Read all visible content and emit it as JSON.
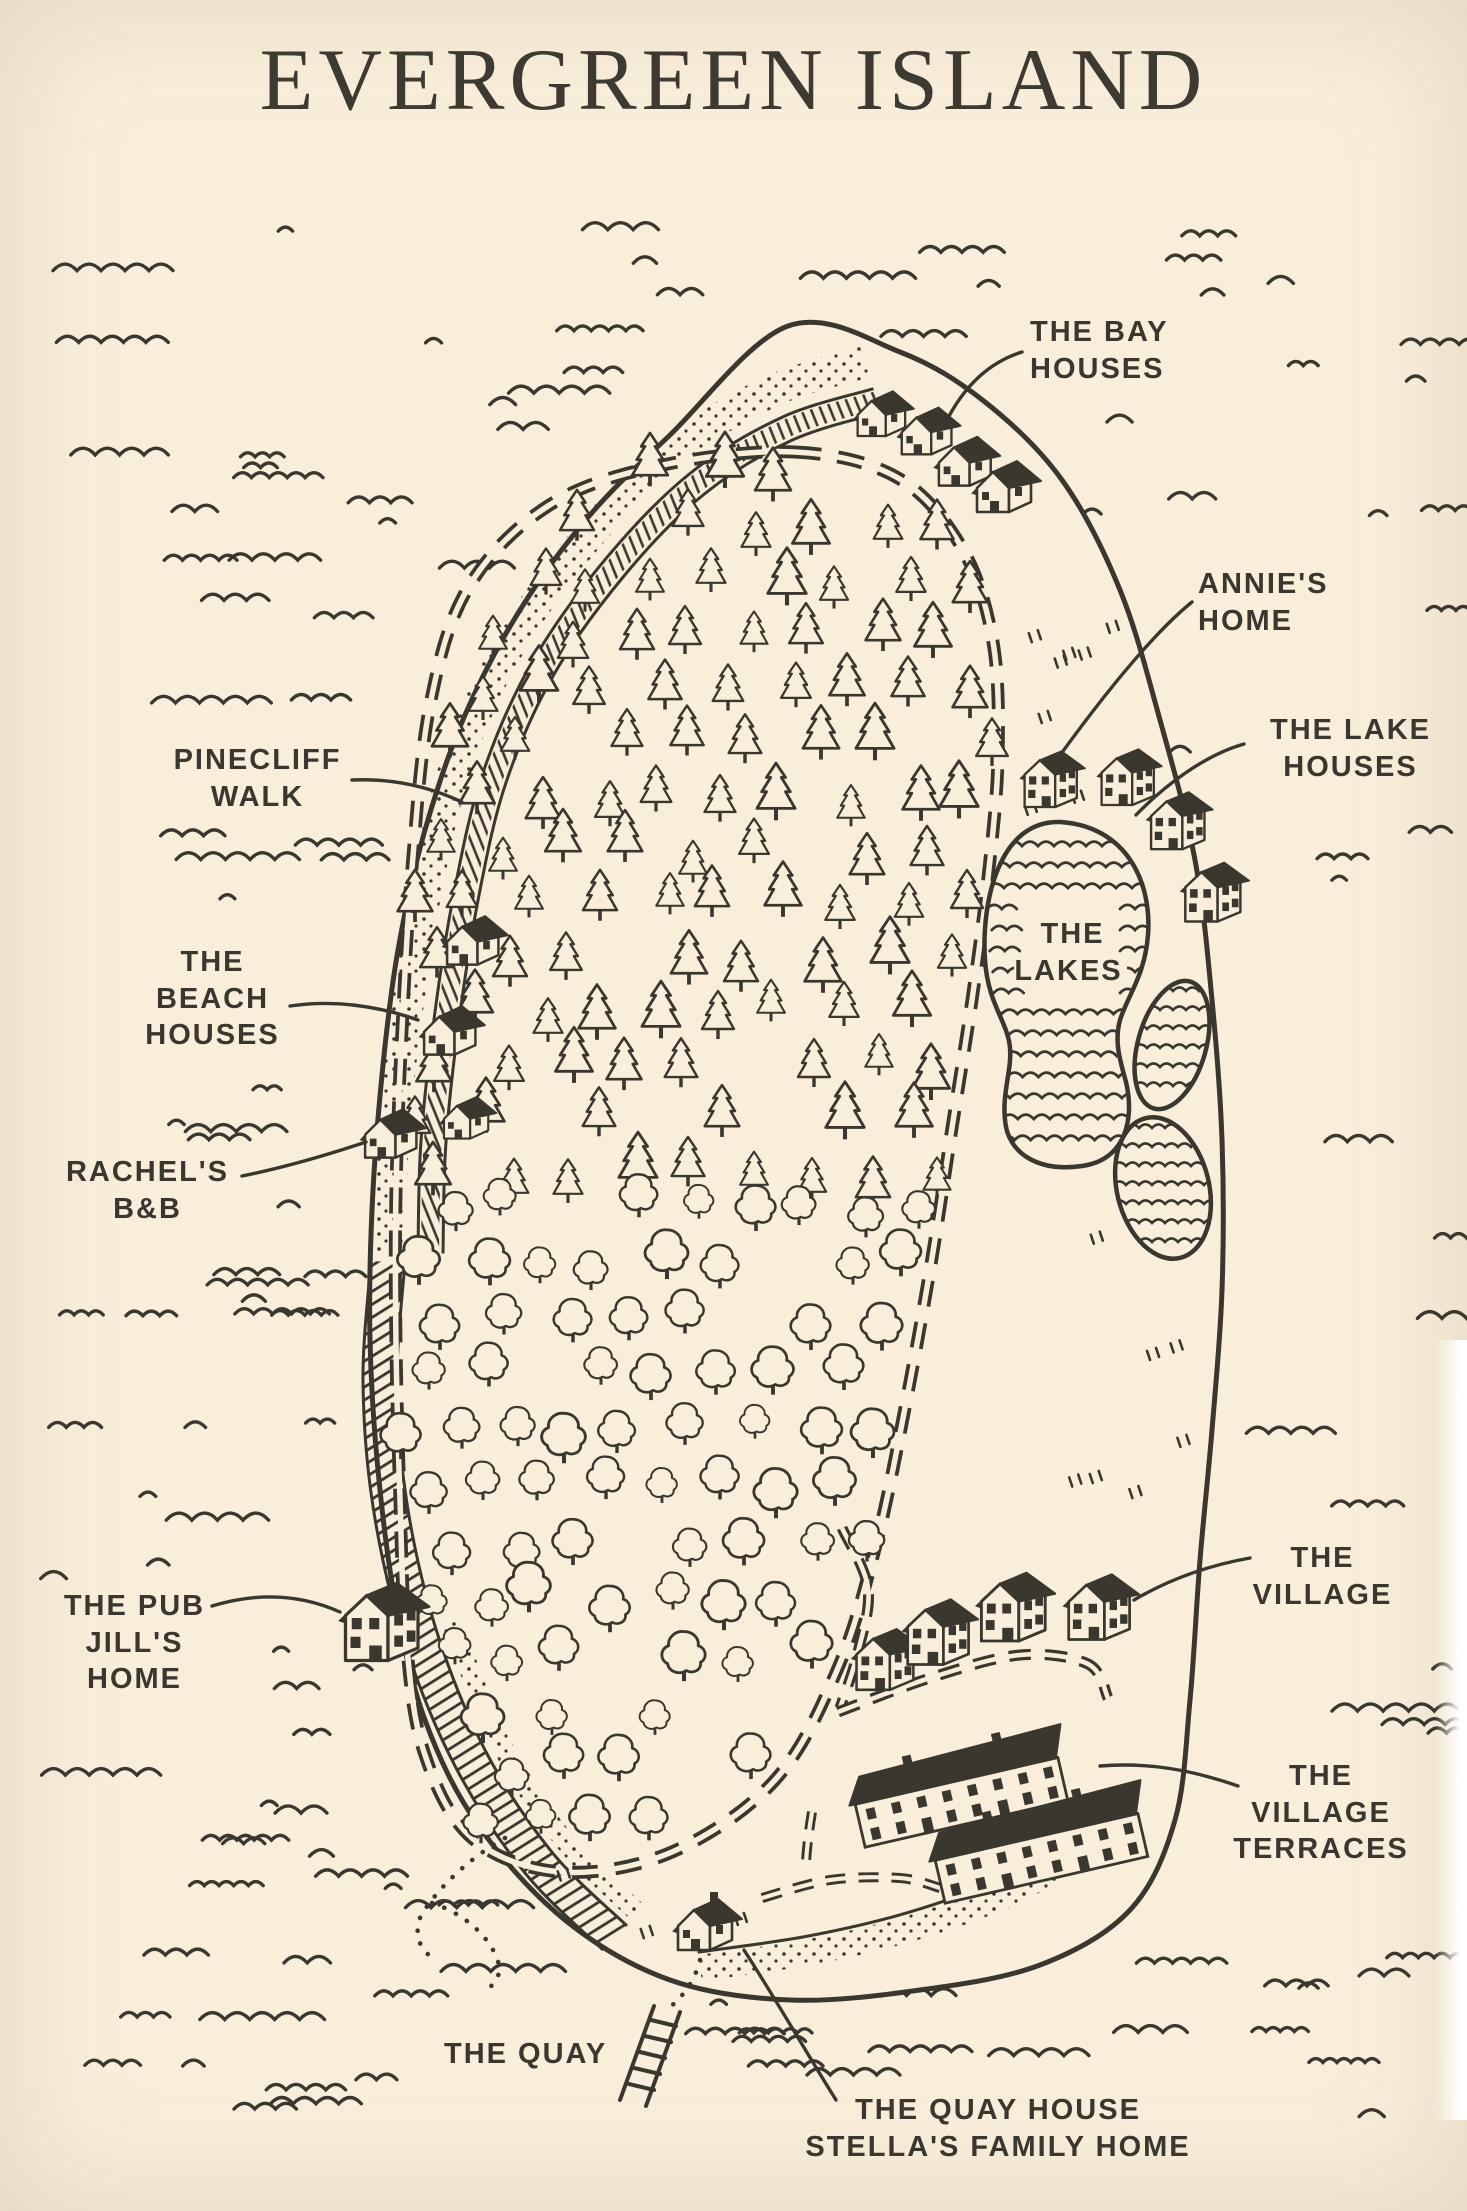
{
  "title": "EVERGREEN ISLAND",
  "labels": {
    "bay_houses": "THE BAY\nHOUSES",
    "annies_home": "ANNIE'S\nHOME",
    "lake_houses": "THE LAKE\nHOUSES",
    "pinecliff_walk": "PINECLIFF\nWALK",
    "beach_houses": "THE\nBEACH\nHOUSES",
    "rachels_bnb": "RACHEL'S\nB&B",
    "the_lakes": "THE\nLAKES",
    "pub_jills_home": "THE PUB\nJILL'S\nHOME",
    "village": "THE\nVILLAGE",
    "village_terraces": "THE\nVILLAGE\nTERRACES",
    "quay": "THE QUAY",
    "quay_house": "THE QUAY HOUSE\nSTELLA'S FAMILY HOME"
  },
  "colors": {
    "paper": "#f8eeda",
    "ink": "#3a372e"
  }
}
